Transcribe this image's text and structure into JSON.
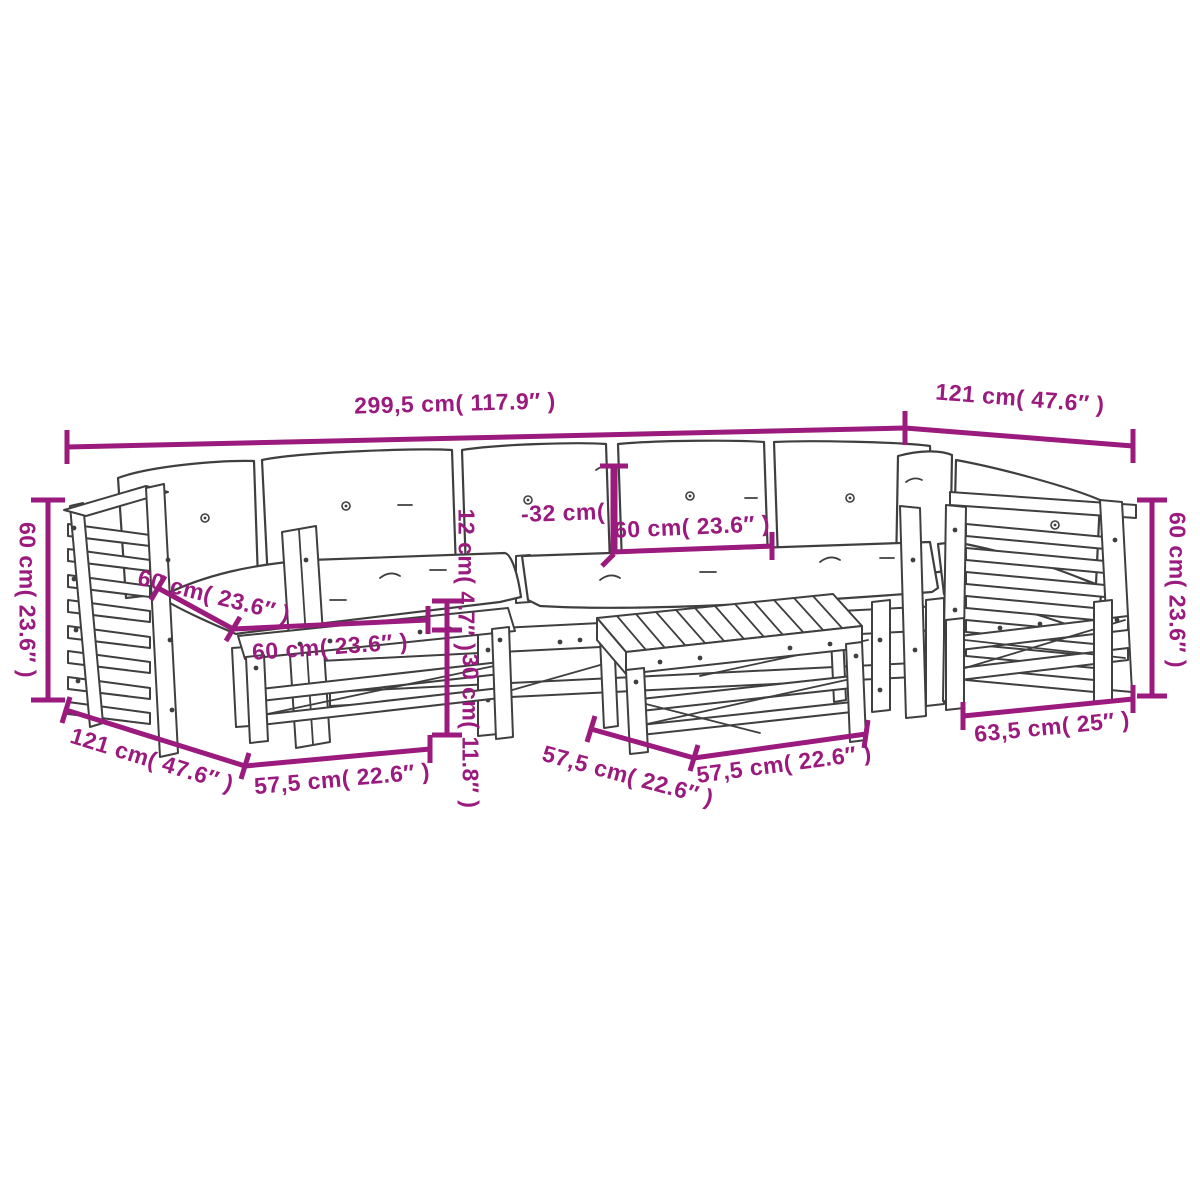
{
  "diagram": {
    "type": "product-dimension-diagram",
    "subject": "wooden garden lounge furniture set line drawing",
    "accent_color": "#9a1a7d",
    "line_color": "#3f3f3f",
    "background_color": "#ffffff",
    "dimensions": [
      {
        "id": "total-width",
        "label": "299,5 cm( 117.9″ )"
      },
      {
        "id": "side-depth-top-right",
        "label": "121 cm( 47.6″ )"
      },
      {
        "id": "backrest-height-left",
        "label": "60 cm( 23.6″ )"
      },
      {
        "id": "back-cushion-height",
        "label": "-32 cm("
      },
      {
        "id": "seat-cushion-width",
        "label": "60 cm( 23.6″ )"
      },
      {
        "id": "seat-cushion-depth",
        "label": "60 cm( 23.6″ )"
      },
      {
        "id": "ottoman-cushion-width",
        "label": "60 cm( 23.6″ )"
      },
      {
        "id": "seat-cushion-thickness",
        "label": "12 cm( 4.7″ )"
      },
      {
        "id": "frame-height",
        "label": "30 cm( 11.8″ )"
      },
      {
        "id": "side-depth-bottom-left",
        "label": "121 cm( 47.6″ )"
      },
      {
        "id": "module-width-1",
        "label": "57,5 cm( 22.6″ )"
      },
      {
        "id": "module-width-2",
        "label": "57,5 cm( 22.6″ )"
      },
      {
        "id": "module-width-3",
        "label": "57,5 cm( 22.6″ )"
      },
      {
        "id": "table-width",
        "label": "63,5 cm( 25″ )"
      },
      {
        "id": "armrest-height-right",
        "label": "60 cm( 23.6″ )"
      }
    ]
  }
}
